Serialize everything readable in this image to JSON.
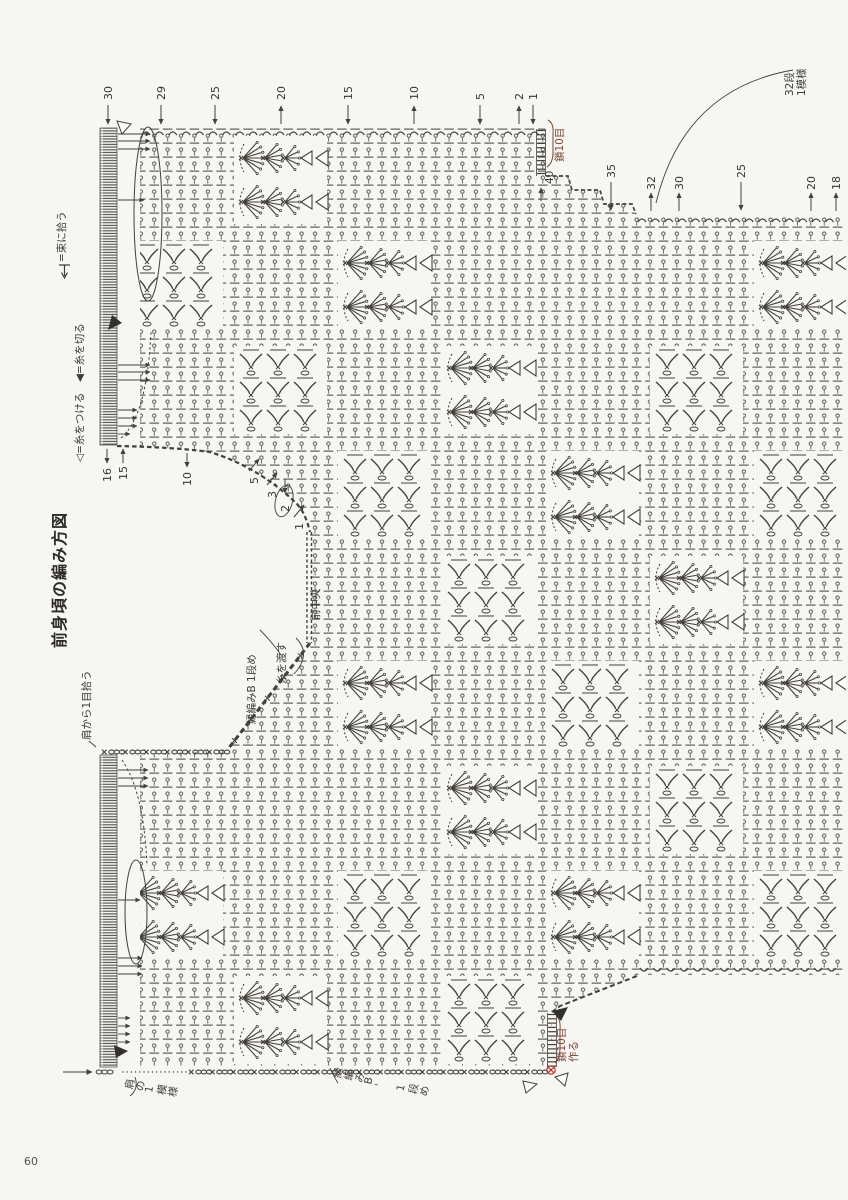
{
  "page": {
    "number": "60"
  },
  "title": "前身頃の編み方図",
  "legends": {
    "bundle_pickup": "=束に拾う",
    "yarn_marks": "◁=糸をつける　◀=糸を切る"
  },
  "annotations": {
    "pattern_repeat": "32段\n1模様",
    "chain10_top": "鎖10目",
    "row_40": "40",
    "front_center": "前中央",
    "carry_yarn": "糸を渡す",
    "edging_b_row1": "縁編みB 1段め",
    "pickup_from_shoulder": "肩から1目拾う",
    "shoulder_one_pattern": "肩の1模様",
    "edging_b2_row1": "縁編みB' 1段め",
    "chain10_make": "鎖10目\n作る",
    "cast_on_40": "40"
  },
  "row_numbers": {
    "top": [
      {
        "n": "30",
        "x": 108,
        "dir": "down"
      },
      {
        "n": "29",
        "x": 161,
        "dir": "down"
      },
      {
        "n": "25",
        "x": 215,
        "dir": "down"
      },
      {
        "n": "20",
        "x": 281,
        "dir": "up"
      },
      {
        "n": "15",
        "x": 348,
        "dir": "down"
      },
      {
        "n": "10",
        "x": 414,
        "dir": "up"
      },
      {
        "n": "5",
        "x": 480,
        "dir": "down"
      },
      {
        "n": "2",
        "x": 519,
        "dir": "up"
      },
      {
        "n": "1",
        "x": 533,
        "dir": "down"
      }
    ],
    "right": [
      {
        "n": "35",
        "x": 611,
        "dir": "down"
      },
      {
        "n": "32",
        "x": 651,
        "dir": "up"
      },
      {
        "n": "30",
        "x": 679,
        "dir": "up"
      },
      {
        "n": "25",
        "x": 741,
        "dir": "down"
      },
      {
        "n": "20",
        "x": 811,
        "dir": "up"
      },
      {
        "n": "18",
        "x": 836,
        "dir": "up"
      }
    ],
    "neck": [
      {
        "n": "16",
        "x": 107,
        "y": 482,
        "dir": "down"
      },
      {
        "n": "15",
        "x": 123,
        "y": 480,
        "dir": "up"
      },
      {
        "n": "10",
        "x": 187,
        "y": 486,
        "dir": "down"
      },
      {
        "n": "5",
        "x": 254,
        "y": 484,
        "dir": "ne"
      },
      {
        "n": "3",
        "x": 272,
        "y": 498,
        "dir": "ne"
      },
      {
        "n": "2",
        "x": 285,
        "y": 512,
        "dir": "down",
        "circled": true
      },
      {
        "n": "1",
        "x": 299,
        "y": 530,
        "dir": "ne"
      }
    ]
  },
  "colors": {
    "ink": "#44403a",
    "light_ink": "#5a564f",
    "red": "#b5352c",
    "label_red": "#7d4337",
    "paper": "#f6f6f2"
  }
}
